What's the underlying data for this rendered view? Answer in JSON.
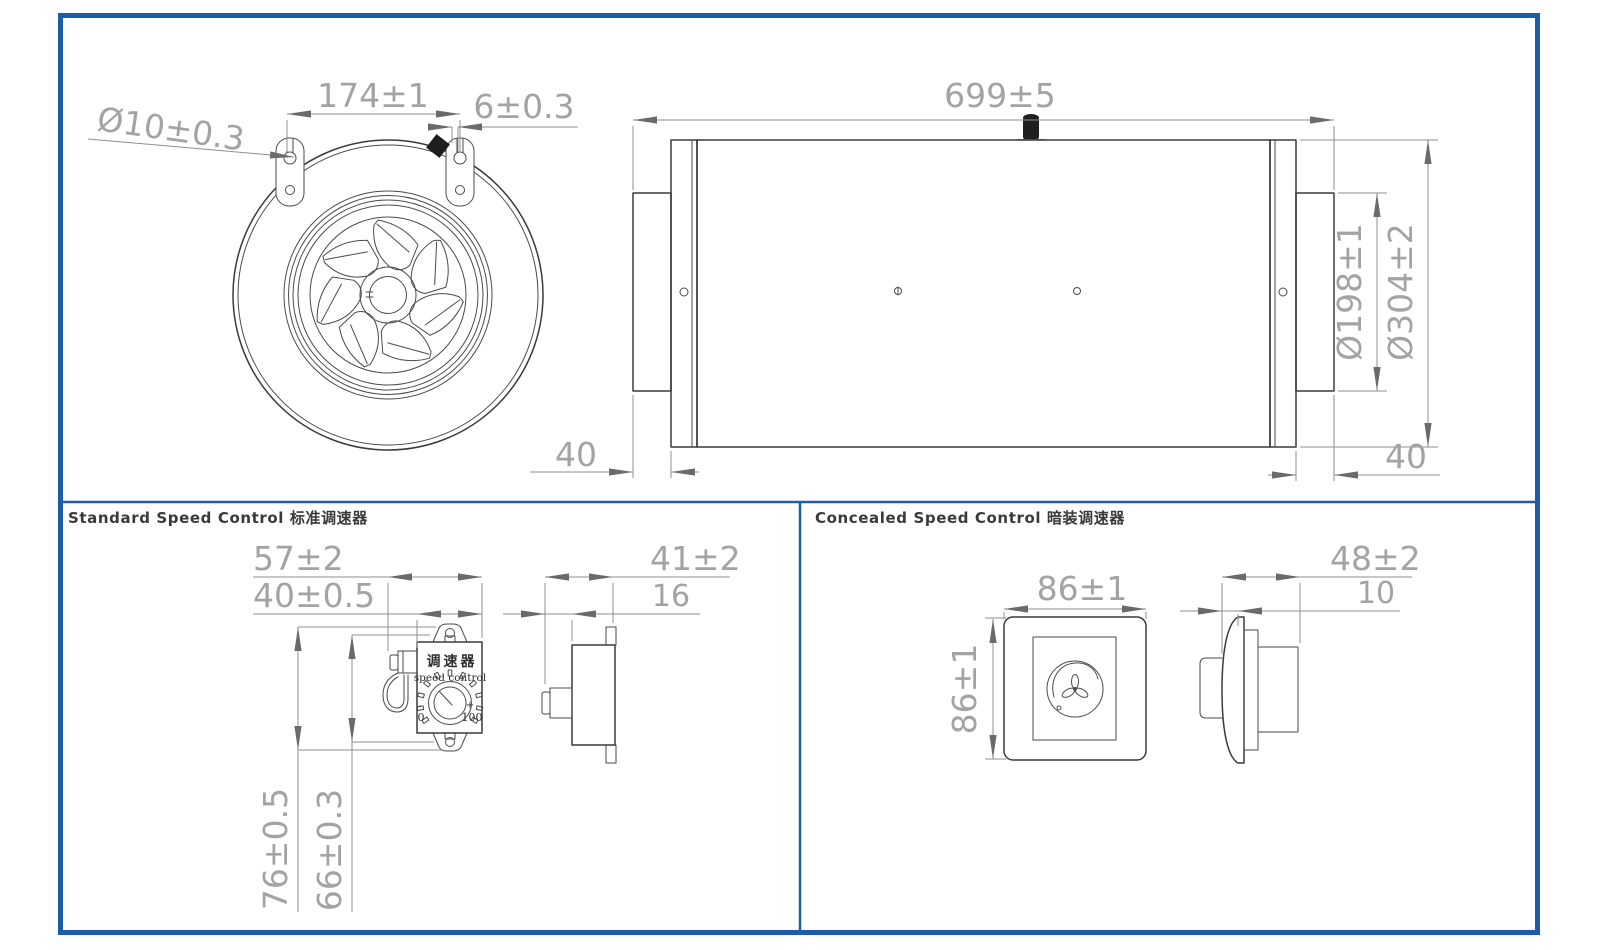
{
  "colors": {
    "frame_blue": "#1d5ca8",
    "object_line": "#3a3a3a",
    "dimension_line": "#8f8f8f",
    "dimension_text": "#a3a3a3",
    "title_text": "#3a3a3a"
  },
  "fan_front": {
    "hole_diameter": "Ø10±0.3",
    "bracket_spacing": "174±1",
    "bracket_offset": "6±0.3"
  },
  "fan_side": {
    "overall_length": "699±5",
    "duct_diameter": "Ø198±1",
    "body_diameter": "Ø304±2",
    "collar_left": "40",
    "collar_right": "40"
  },
  "standard": {
    "title": "Standard Speed Control 标准调速器",
    "width_overall": "57±2",
    "width_body": "40±0.5",
    "height_overall": "76±0.5",
    "height_body": "66±0.3",
    "depth_overall": "41±2",
    "depth_knob": "16",
    "label_cn": "调速器",
    "label_en": "speed control",
    "scale_min": "0",
    "scale_max": "100",
    "scale_minus": "-",
    "scale_plus": "+"
  },
  "concealed": {
    "title": "Concealed Speed Control 暗装调速器",
    "width": "86±1",
    "height": "86±1",
    "depth_overall": "48±2",
    "plate_thickness": "10"
  }
}
